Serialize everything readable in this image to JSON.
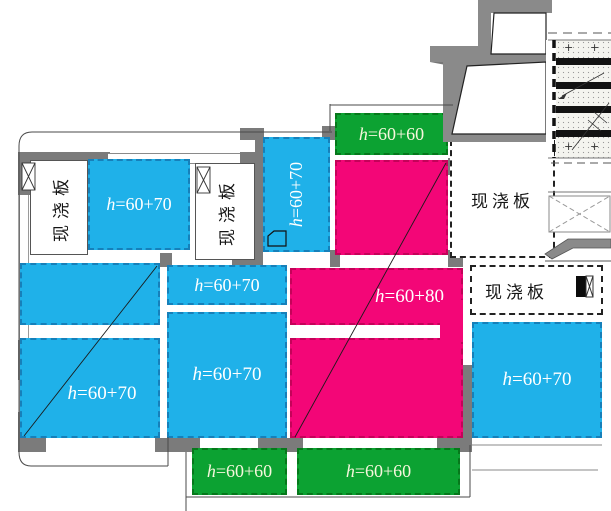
{
  "title": "cast-in-place slab plan",
  "colors": {
    "cyan": "#1FB1E9",
    "magenta": "#F30677",
    "green": "#0CA232",
    "wall": "#7B7B7B",
    "line": "#3F3F3F",
    "label_text": "#FFFFFF",
    "green_label_text": "#F7F7DD"
  },
  "labels": {
    "plus_mark": "+"
  },
  "slabs": [
    {
      "id": "cyan-top-left",
      "color": "cyan",
      "label": "h=60+70"
    },
    {
      "id": "cyan-vertical",
      "color": "cyan",
      "label": "h=60+70"
    },
    {
      "id": "cyan-mid-small",
      "color": "cyan",
      "label": "h=60+70"
    },
    {
      "id": "cyan-mid-large",
      "color": "cyan",
      "label": "h=60+70"
    },
    {
      "id": "cyan-left-upper",
      "color": "cyan",
      "label": ""
    },
    {
      "id": "cyan-left-lower",
      "color": "cyan",
      "label": "h=60+70"
    },
    {
      "id": "cyan-bottom-right",
      "color": "cyan",
      "label": "h=60+70"
    },
    {
      "id": "green-top",
      "color": "green",
      "label": "h=60+60"
    },
    {
      "id": "green-bottom-left",
      "color": "green",
      "label": "h=60+60"
    },
    {
      "id": "green-bottom-right",
      "color": "green",
      "label": "h=60+60"
    },
    {
      "id": "magenta-upper",
      "color": "magenta",
      "label": ""
    },
    {
      "id": "magenta-middle",
      "color": "magenta",
      "label": "h=60+80"
    },
    {
      "id": "magenta-lower",
      "color": "magenta",
      "label": ""
    }
  ],
  "white_panels": [
    {
      "id": "cast-slab-left-vertical",
      "label": "现浇板"
    },
    {
      "id": "cast-slab-center-vertical",
      "label": "现浇板"
    },
    {
      "id": "cast-slab-right-upper",
      "label": "现浇板"
    },
    {
      "id": "cast-slab-right-lower",
      "label": "现浇板"
    }
  ]
}
